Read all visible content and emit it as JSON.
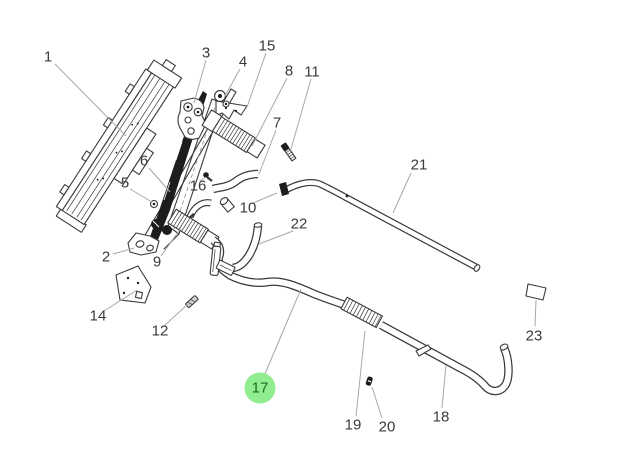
{
  "canvas": {
    "width": 618,
    "height": 468,
    "background": "#ffffff"
  },
  "diagram_type": "exploded-parts-diagram",
  "highlighted_part": "17",
  "colors": {
    "line": "#3a3a3a",
    "leader": "#a8a8a8",
    "label_text": "#3b3b3b",
    "highlight_bg": "#90ee90",
    "highlight_text": "#1e6b1e"
  },
  "labels": [
    {
      "text": "1",
      "x": 48,
      "y": 57,
      "leader": [
        55,
        64,
        126,
        136
      ],
      "highlighted": false
    },
    {
      "text": "2",
      "x": 106,
      "y": 257,
      "leader": [
        113,
        254,
        134,
        248
      ],
      "highlighted": false
    },
    {
      "text": "3",
      "x": 206,
      "y": 53,
      "leader": [
        206,
        60,
        194,
        103
      ],
      "highlighted": false
    },
    {
      "text": "4",
      "x": 243,
      "y": 62,
      "leader": [
        240,
        69,
        225,
        96
      ],
      "highlighted": false
    },
    {
      "text": "5",
      "x": 125,
      "y": 183,
      "leader": [
        130,
        189,
        152,
        202
      ],
      "highlighted": false
    },
    {
      "text": "6",
      "x": 144,
      "y": 161,
      "leader": [
        149,
        168,
        170,
        192
      ],
      "highlighted": false
    },
    {
      "text": "7",
      "x": 277,
      "y": 123,
      "leader": [
        276,
        130,
        259,
        174
      ],
      "highlighted": false
    },
    {
      "text": "8",
      "x": 289,
      "y": 71,
      "leader": [
        287,
        78,
        252,
        146
      ],
      "highlighted": false
    },
    {
      "text": "9",
      "x": 157,
      "y": 262,
      "leader": [
        161,
        256,
        181,
        228
      ],
      "highlighted": false
    },
    {
      "text": "10",
      "x": 248,
      "y": 208,
      "leader": [
        253,
        203,
        277,
        193
      ],
      "highlighted": false
    },
    {
      "text": "11",
      "x": 312,
      "y": 72,
      "leader": [
        311,
        79,
        291,
        149
      ],
      "highlighted": false
    },
    {
      "text": "12",
      "x": 160,
      "y": 331,
      "leader": [
        164,
        326,
        188,
        304
      ],
      "highlighted": false
    },
    {
      "text": "14",
      "x": 98,
      "y": 316,
      "leader": [
        104,
        311,
        137,
        290
      ],
      "highlighted": false
    },
    {
      "text": "15",
      "x": 267,
      "y": 46,
      "leader": [
        266,
        53,
        247,
        107
      ],
      "highlighted": false
    },
    {
      "text": "16",
      "x": 198,
      "y": 186,
      "leader": [
        200,
        181,
        206,
        177
      ],
      "highlighted": false
    },
    {
      "text": "17",
      "x": 260,
      "y": 388,
      "leader": [
        264,
        376,
        301,
        289
      ],
      "highlighted": true
    },
    {
      "text": "18",
      "x": 441,
      "y": 417,
      "leader": [
        442,
        408,
        446,
        365
      ],
      "highlighted": false
    },
    {
      "text": "19",
      "x": 353,
      "y": 425,
      "leader": [
        356,
        416,
        365,
        331
      ],
      "highlighted": false
    },
    {
      "text": "20",
      "x": 387,
      "y": 427,
      "leader": [
        382,
        418,
        372,
        387
      ],
      "highlighted": false
    },
    {
      "text": "21",
      "x": 419,
      "y": 165,
      "leader": [
        411,
        173,
        393,
        213
      ],
      "highlighted": false
    },
    {
      "text": "22",
      "x": 299,
      "y": 224,
      "leader": [
        293,
        231,
        259,
        244
      ],
      "highlighted": false
    },
    {
      "text": "23",
      "x": 534,
      "y": 336,
      "leader": [
        535,
        326,
        536,
        300
      ],
      "highlighted": false
    }
  ]
}
